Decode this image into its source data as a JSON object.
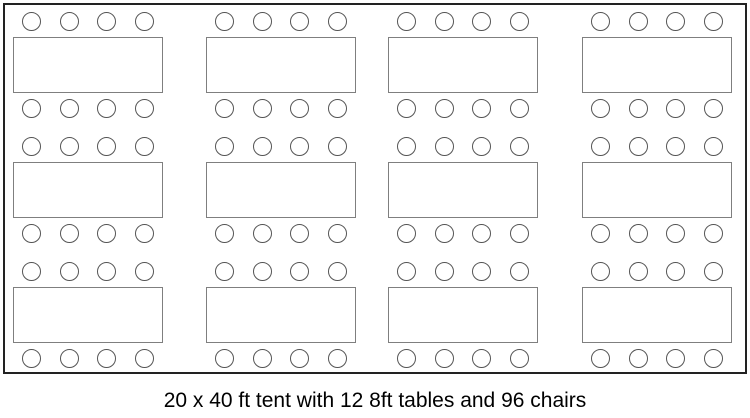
{
  "caption": "20 x 40 ft tent with 12 8ft tables and 96 chairs",
  "diagram": {
    "tent": {
      "x": 3,
      "y": 3,
      "width": 744,
      "height": 371,
      "border_width": 2,
      "border_color": "#222222"
    },
    "grid": {
      "columns_x": [
        13,
        206,
        388,
        582
      ],
      "rows_y": [
        37,
        162,
        287
      ],
      "table_width": 150,
      "table_height": 56,
      "table_border_width": 1.5,
      "table_border_color": "#7f7f7f",
      "chair_diameter": 19,
      "chair_border_width": 1.5,
      "chair_border_color": "#555555",
      "chairs_per_side": 2,
      "chairs_per_row": 4,
      "chair_table_gap": 6
    },
    "table_count": 12,
    "table_size_label": "8ft",
    "chair_count": 96,
    "tent_size_label": "20 x 40 ft"
  }
}
